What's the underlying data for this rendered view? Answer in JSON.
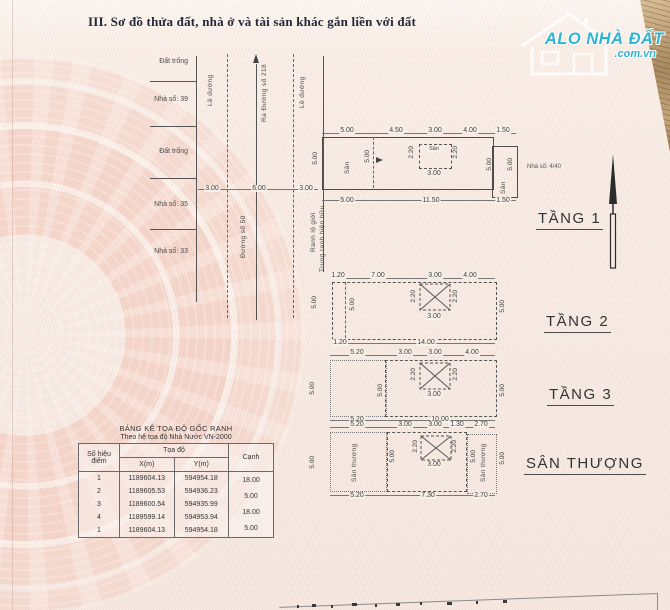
{
  "title": "III. Sơ đồ thửa đất, nhà ở và tài sản khác gắn liền với đất",
  "logo": {
    "brand": "ALO NHÀ ĐẤT",
    "domain": ".com.vn"
  },
  "colors": {
    "brand": "#2db5d2",
    "paper": "#f8eee7",
    "emblem": "#f3c1b2",
    "line": "#4c4c4c"
  },
  "site": {
    "labels_left": [
      "Đất trống",
      "Nhà số: 39",
      "Đất trống",
      "Nhà số: 35",
      "Nhà số: 33"
    ],
    "curb_left": "Lề đường",
    "curb_right": "Lề đường",
    "to_street": "Ra Đường số 218",
    "street_name": "Đường số 50",
    "boundary_road": "Ranh lộ giới",
    "boundary_existing": "Trung ranh hiện hữu",
    "road_dims": [
      "3.00",
      "6.00",
      "3.00"
    ]
  },
  "floor1": {
    "label": "TẦNG 1",
    "house_no": "Nhà số: 4/40",
    "top_dims": [
      "5.00",
      "4.50",
      "3.00",
      "4.00",
      "1.50"
    ],
    "bottom_dims": [
      "5.00",
      "11.50",
      "1.50"
    ],
    "left_dim": "5.00",
    "inner_dim": "5.00",
    "front_yard": "Sân",
    "mid_yard": {
      "label": "Sân",
      "left": "2.20",
      "right": "2.20",
      "bottom": "3.00"
    },
    "back": {
      "inner_dim": "5.00",
      "outer_dim": "5.00",
      "yard": "Sân"
    }
  },
  "floor2": {
    "label": "TẦNG 2",
    "top_dims": [
      "1.20",
      "7.00",
      "3.00",
      "4.00"
    ],
    "bottom_dims": [
      "1.20",
      "14.00"
    ],
    "left_dim": "5.00",
    "inner_dim": "5.00",
    "right_dim": "5.00",
    "void": {
      "left": "2.20",
      "right": "2.20",
      "bottom": "3.00"
    }
  },
  "floor3": {
    "label": "TẦNG 3",
    "top_dims": [
      "5.20",
      "3.00",
      "3.00",
      "4.00"
    ],
    "bottom_dims": [
      "5.20",
      "10.00"
    ],
    "left_dim": "5.00",
    "inner_dim": "5.00",
    "right_dim": "5.00",
    "void": {
      "left": "2.20",
      "right": "2.20",
      "bottom": "3.00"
    }
  },
  "roof": {
    "label": "SÂN THƯỢNG",
    "top_dims": [
      "5.20",
      "3.00",
      "3.00",
      "1.30",
      "2.70"
    ],
    "bottom_dims": [
      "5.20",
      "7.30",
      "2.70"
    ],
    "left_dim": "5.00",
    "inner_dim": "5.00",
    "terrace_left": "Sân thượng",
    "terrace_right": "Sân thượng",
    "right_inner_dim": "5.00",
    "right_dim": "5.00",
    "void": {
      "left": "2.20",
      "right": "2.20",
      "bottom": "3.00"
    }
  },
  "table": {
    "title": "BẢNG KÊ TỌA ĐỘ GỐC RANH",
    "subtitle": "Theo hệ tọa độ Nhà Nước VN-2000",
    "col_point": "Số hiệu điểm",
    "col_coords": "Tọa độ",
    "col_x": "X(m)",
    "col_y": "Y(m)",
    "col_edge": "Cạnh",
    "rows": [
      {
        "id": "1",
        "x": "1189604.13",
        "y": "594954.18"
      },
      {
        "id": "2",
        "x": "1189605.53",
        "y": "594936.23"
      },
      {
        "id": "3",
        "x": "1189600.54",
        "y": "594935.99"
      },
      {
        "id": "4",
        "x": "1189599.14",
        "y": "594953.94"
      },
      {
        "id": "1",
        "x": "1189604.13",
        "y": "594954.18"
      }
    ],
    "edges": [
      "18.00",
      "5.00",
      "18.00",
      "5.00"
    ]
  }
}
